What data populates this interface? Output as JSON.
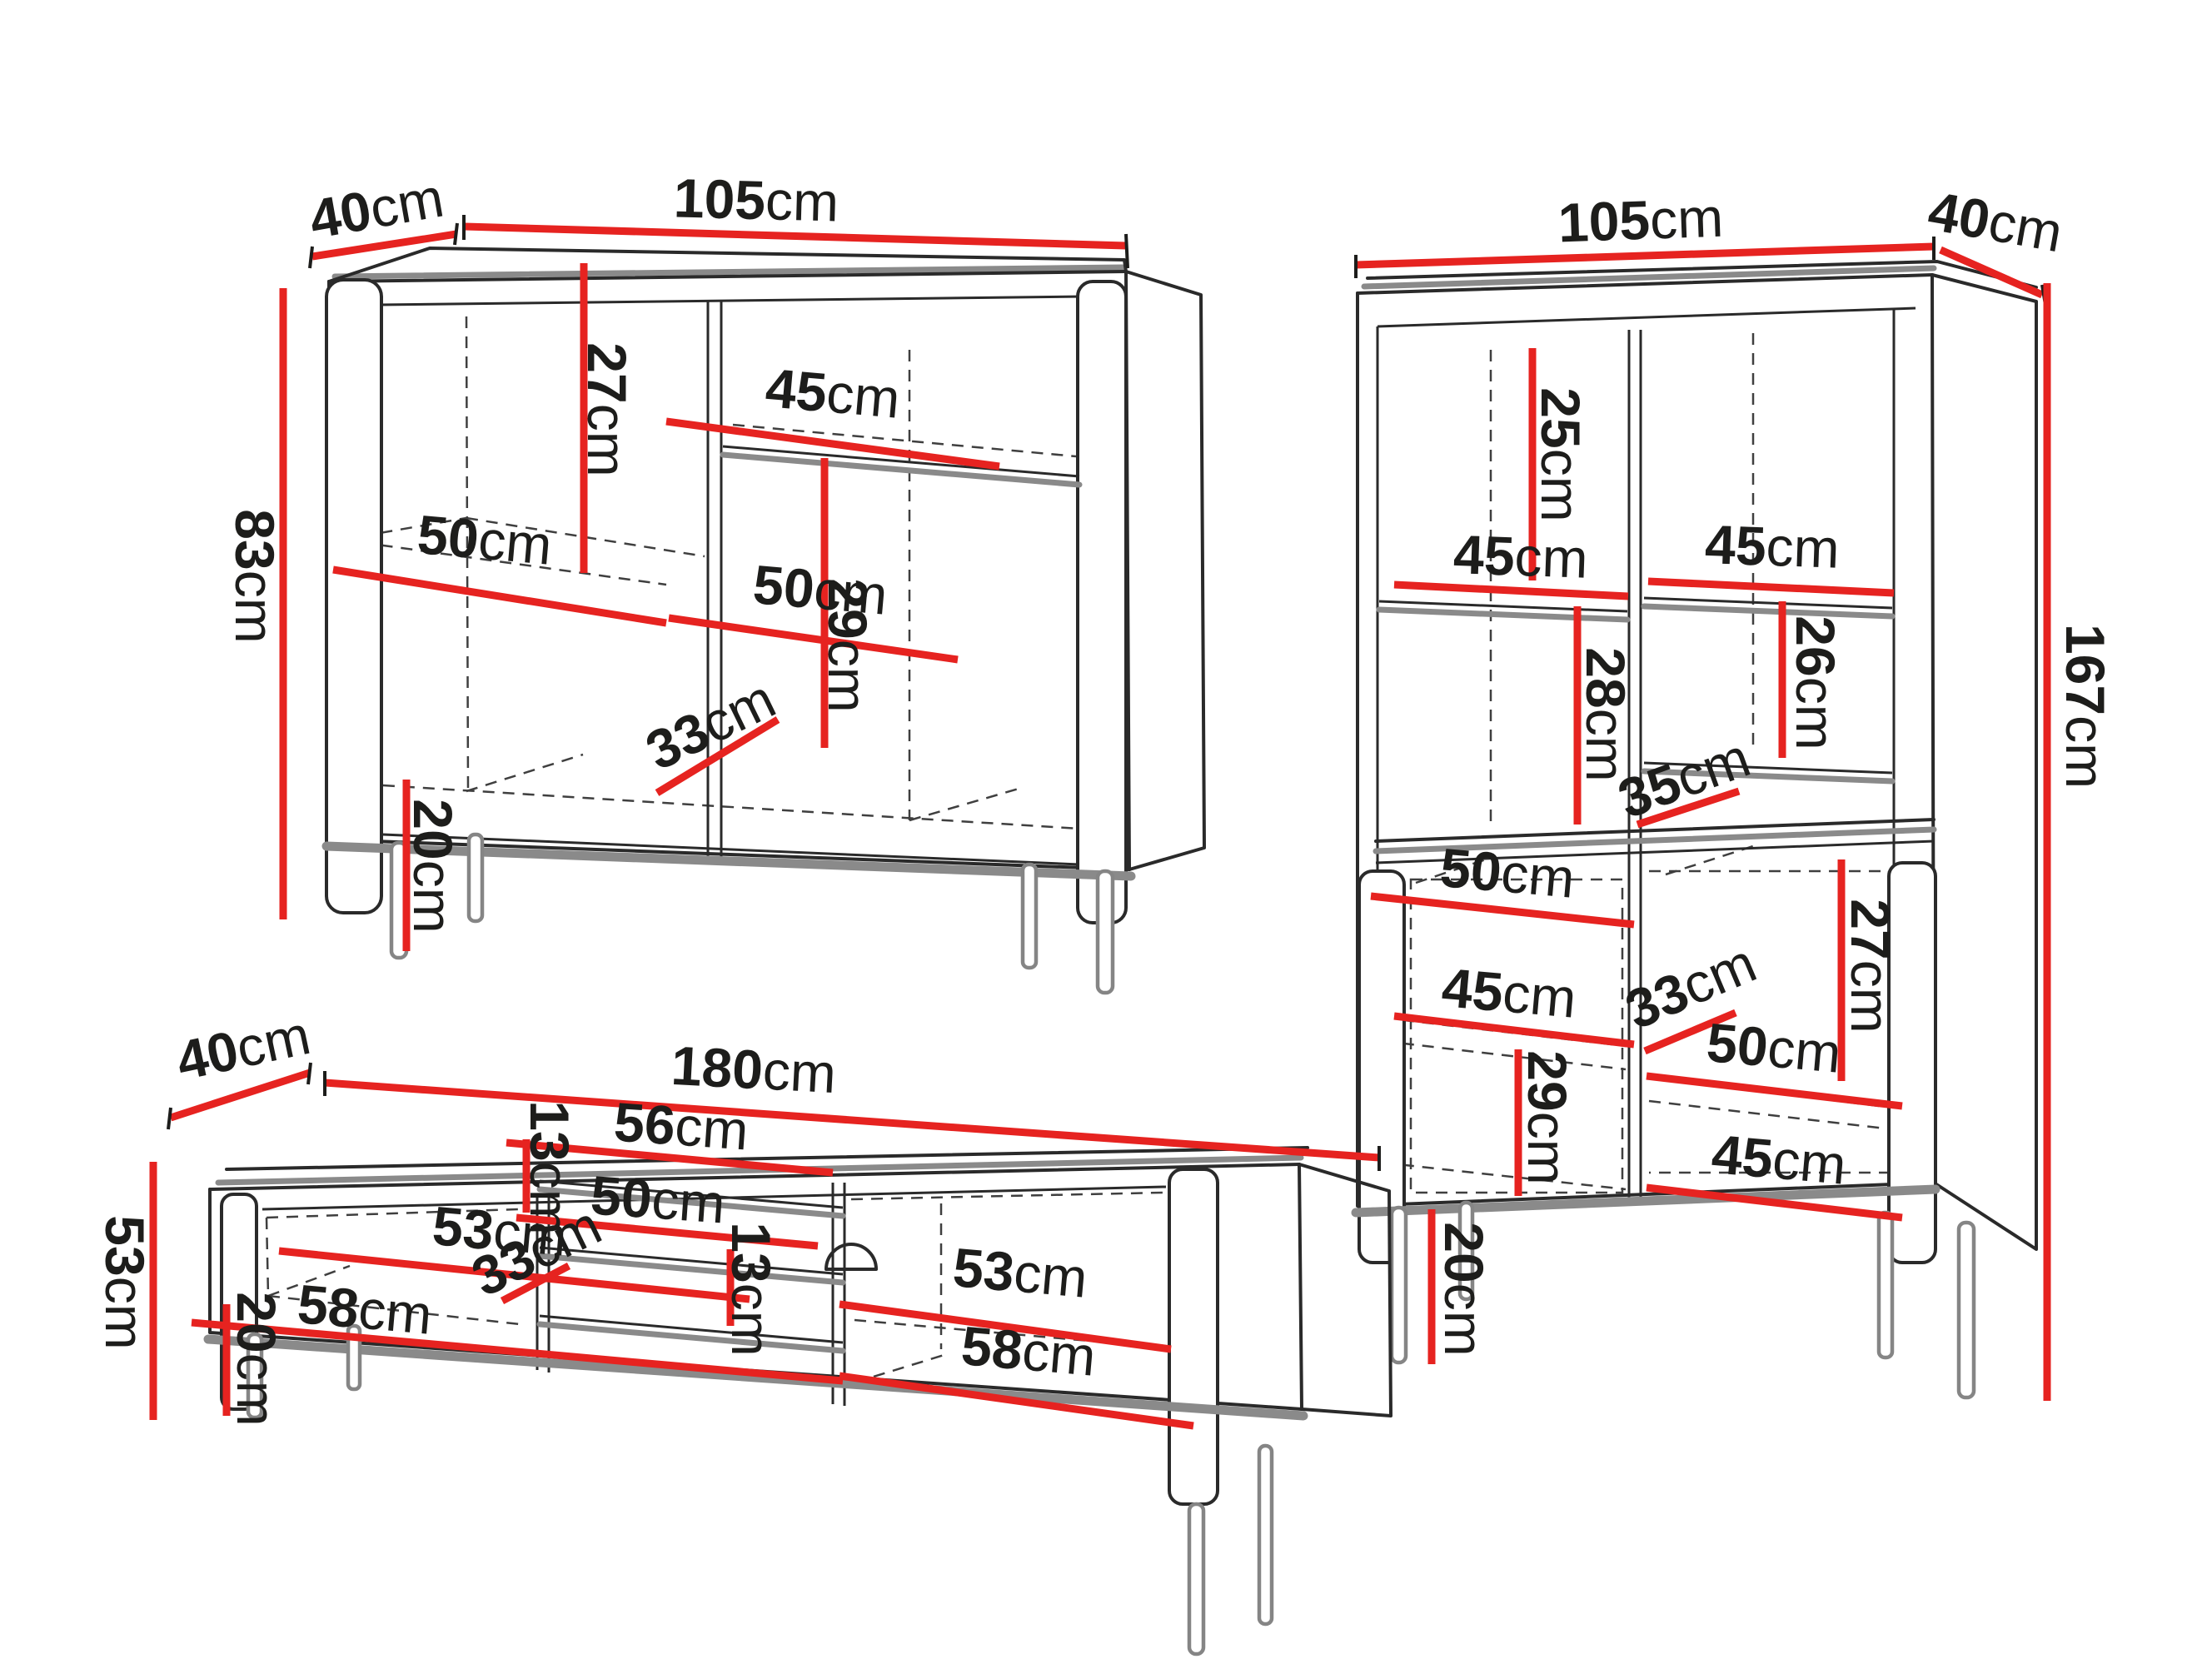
{
  "diagram": {
    "type": "furniture-dimension-drawing",
    "units": "cm",
    "background_color": "#ffffff",
    "dimension_line_color": "#e62320",
    "outline_color": "#2a2a2a",
    "shading_color": "#8a8a8a",
    "text_color": "#1d1d1b"
  },
  "pieces": {
    "sideboard": {
      "name": "sideboard",
      "labels": {
        "depth": {
          "num": "40",
          "unit": "cm"
        },
        "width": {
          "num": "105",
          "unit": "cm"
        },
        "height": {
          "num": "83",
          "unit": "cm"
        },
        "divider_clearance": {
          "num": "27",
          "unit": "cm"
        },
        "right_shelf_width": {
          "num": "45",
          "unit": "cm"
        },
        "left_width": {
          "num": "50",
          "unit": "cm"
        },
        "right_width": {
          "num": "50",
          "unit": "cm"
        },
        "right_clearance": {
          "num": "29",
          "unit": "cm"
        },
        "interior_depth": {
          "num": "33",
          "unit": "cm"
        },
        "leg_height": {
          "num": "20",
          "unit": "cm"
        }
      }
    },
    "bookcase": {
      "name": "display cabinet",
      "labels": {
        "width": {
          "num": "105",
          "unit": "cm"
        },
        "depth": {
          "num": "40",
          "unit": "cm"
        },
        "height": {
          "num": "167",
          "unit": "cm"
        },
        "top_left_clearance": {
          "num": "25",
          "unit": "cm"
        },
        "top_right_shelf_width": {
          "num": "45",
          "unit": "cm"
        },
        "top_right_clearance": {
          "num": "26",
          "unit": "cm"
        },
        "left_shelf_width": {
          "num": "45",
          "unit": "cm"
        },
        "left_clearance": {
          "num": "28",
          "unit": "cm"
        },
        "shelf_depth": {
          "num": "35",
          "unit": "cm"
        },
        "left_door_width": {
          "num": "50",
          "unit": "cm"
        },
        "right_door_clearance": {
          "num": "27",
          "unit": "cm"
        },
        "left_door_shelf_width": {
          "num": "45",
          "unit": "cm"
        },
        "door_interior_depth": {
          "num": "33",
          "unit": "cm"
        },
        "left_door_clearance": {
          "num": "29",
          "unit": "cm"
        },
        "right_door_width": {
          "num": "50",
          "unit": "cm"
        },
        "right_door_shelf_width": {
          "num": "45",
          "unit": "cm"
        },
        "leg_height": {
          "num": "20",
          "unit": "cm"
        }
      }
    },
    "tv_stand": {
      "name": "TV stand",
      "labels": {
        "depth": {
          "num": "40",
          "unit": "cm"
        },
        "width": {
          "num": "180",
          "unit": "cm"
        },
        "height": {
          "num": "53",
          "unit": "cm"
        },
        "left_width": {
          "num": "53",
          "unit": "cm"
        },
        "left_door_width": {
          "num": "58",
          "unit": "cm"
        },
        "top_niche_height": {
          "num": "13",
          "unit": "cm"
        },
        "niche_width": {
          "num": "56",
          "unit": "cm"
        },
        "niche_shelf_width": {
          "num": "50",
          "unit": "cm"
        },
        "interior_depth": {
          "num": "33",
          "unit": "cm"
        },
        "bottom_niche_height": {
          "num": "13",
          "unit": "cm"
        },
        "right_width": {
          "num": "53",
          "unit": "cm"
        },
        "right_door_width": {
          "num": "58",
          "unit": "cm"
        },
        "leg_height": {
          "num": "20",
          "unit": "cm"
        }
      }
    }
  }
}
